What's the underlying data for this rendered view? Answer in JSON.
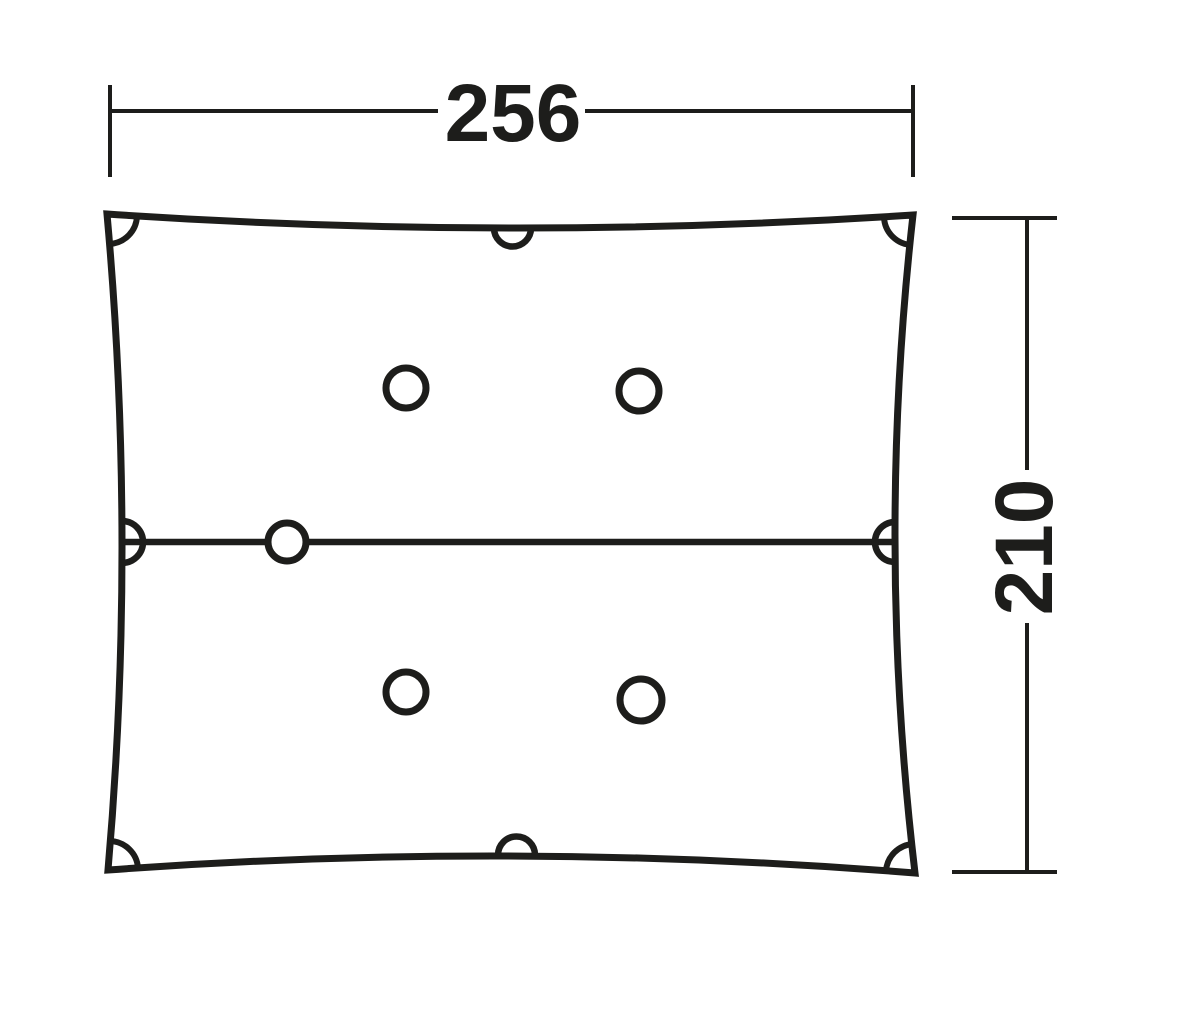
{
  "figure": {
    "kind": "technical dimension drawing",
    "subject": "rectangular tarp / footprint groundsheet, top view",
    "features": {
      "corner_grommet_arcs": 4,
      "edge_half_circle_tieouts": 4,
      "inner_ring_points": 5,
      "center_seam_line": 1
    }
  },
  "dimensions": {
    "width": {
      "value": "256",
      "orientation": "horizontal",
      "position": "top"
    },
    "height": {
      "value": "210",
      "orientation": "vertical",
      "position": "right"
    }
  },
  "colors": {
    "ink": "#1d1d1b",
    "background": "#ffffff"
  }
}
